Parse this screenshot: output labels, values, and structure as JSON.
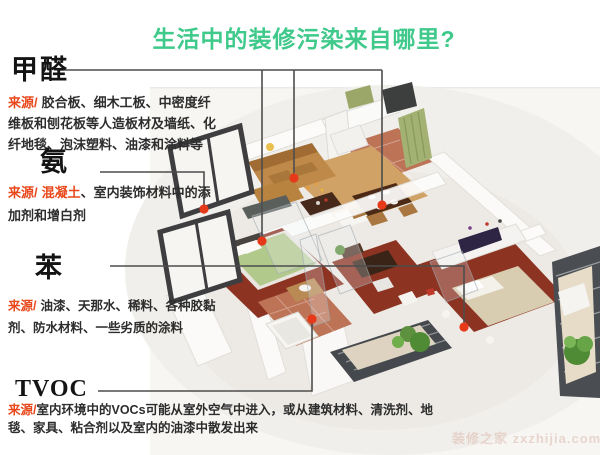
{
  "title": {
    "text": "生活中的装修污染来自哪里?"
  },
  "colors": {
    "title_green": "#3fc98a",
    "source_red": "#e8481c",
    "pollution_dot_red": "#e6391a",
    "connector_line_gray": "#4d4d4d"
  },
  "sections": [
    {
      "id": "formaldehyde",
      "label": "甲醛",
      "source_prefix": "来源/",
      "source_highlight": "",
      "source_text": "胶合板、细木工板、中密度纤维板和刨花板等人造板材及墙纸、化纤地毯、泡沫塑料、油漆和涂料等"
    },
    {
      "id": "ammonia",
      "label": "氨",
      "source_prefix": "来源/",
      "source_highlight": "混凝土",
      "source_text": "、室内装饰材料中的添加剂和增白剂"
    },
    {
      "id": "benzene",
      "label": "苯",
      "source_prefix": "来源/",
      "source_highlight": "",
      "source_text": "油漆、天那水、稀料、各种胶黏剂、防水材料、一些劣质的涂料"
    },
    {
      "id": "tvoc",
      "label": "TVOC",
      "source_prefix": "来源/",
      "source_highlight": "",
      "source_text": "室内环境中的VOCs可能从室外空气中进入，或从建筑材料、清洗剂、地毯、家具、粘合剂以及室内的油漆中散发出来"
    }
  ],
  "watermark": {
    "text": "装修之家 zxzhijia.com"
  }
}
